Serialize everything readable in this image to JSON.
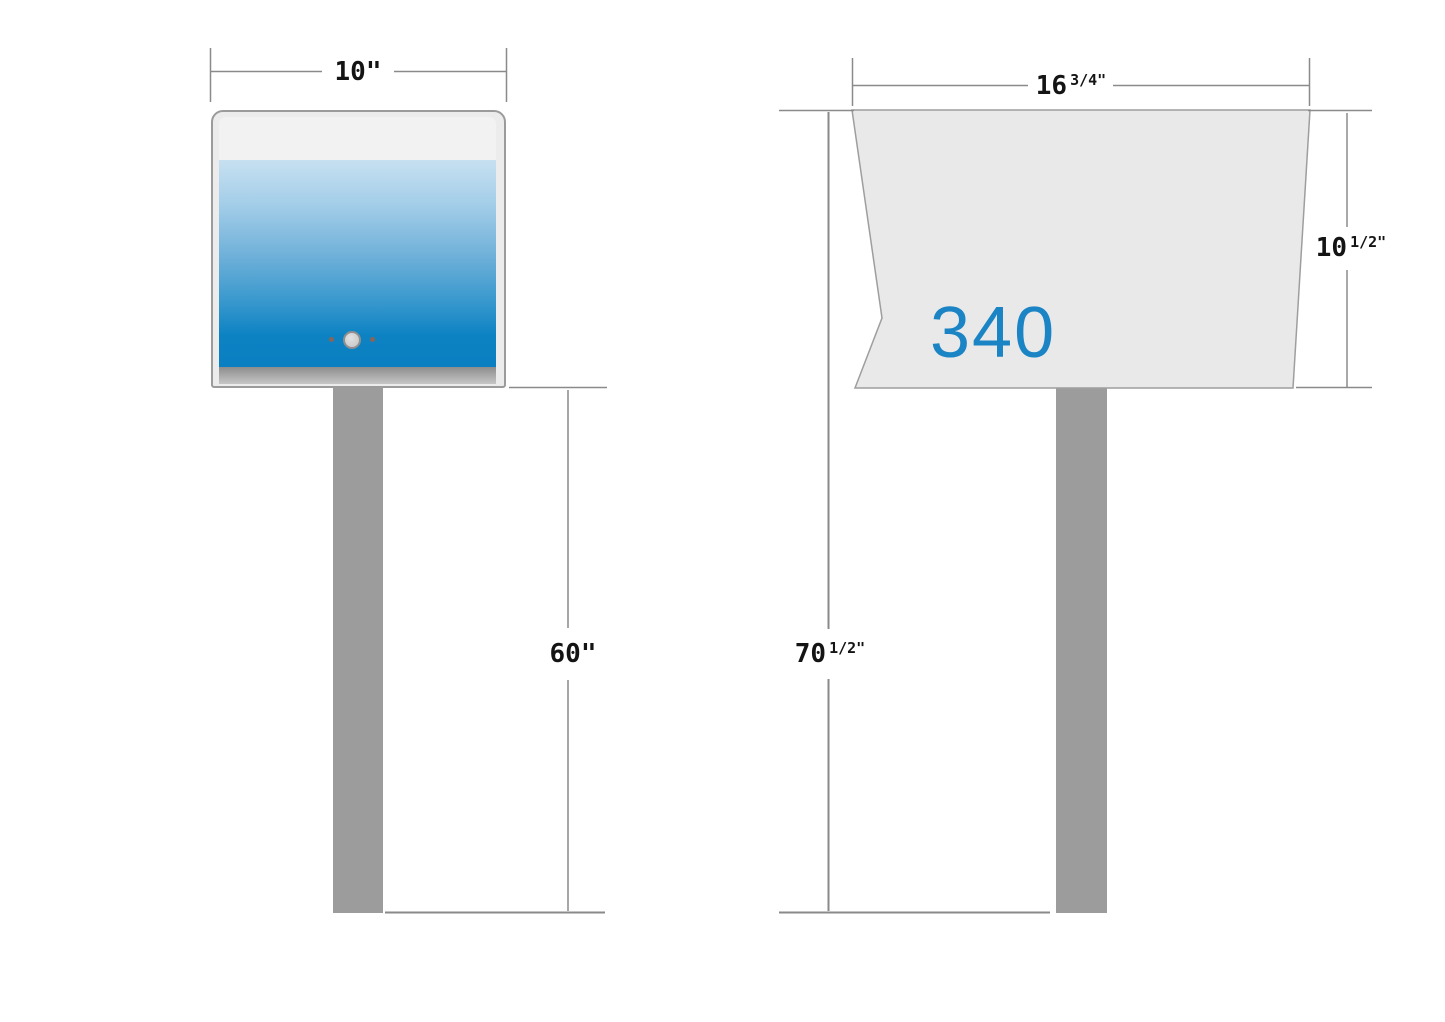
{
  "front_view": {
    "width_label": {
      "value": "10\""
    },
    "post_height_label": {
      "value": "60\""
    }
  },
  "side_view": {
    "width_label": {
      "value": "16",
      "fraction": "3/4\""
    },
    "total_height_label": {
      "value": "70",
      "fraction": "1/2\""
    },
    "body_height_label": {
      "value": "10",
      "fraction": "1/2\""
    },
    "box_number": "340"
  },
  "colors": {
    "accent_blue": "#1b84c5",
    "door_gradient_top": "#c7e0f1",
    "door_gradient_bottom": "#0a80c2",
    "panel_gray": "#e9e9e9",
    "post_gray": "#9c9c9c",
    "line_gray": "#8a8a8a"
  }
}
